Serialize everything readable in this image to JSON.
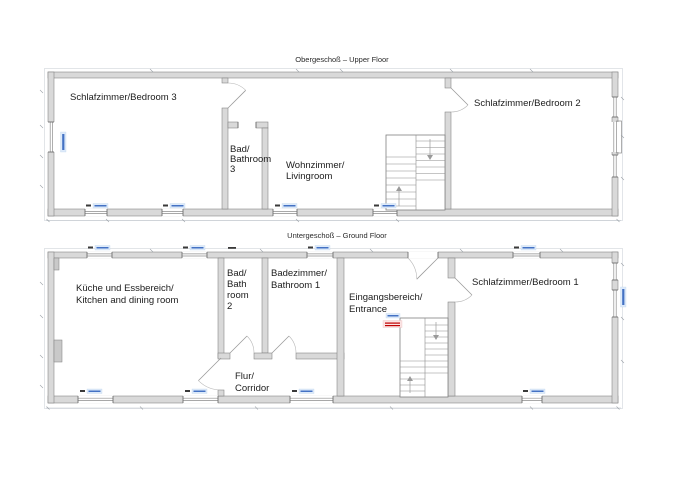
{
  "document": {
    "type": "architectural floor plan, two storeys",
    "background_color": "#ffffff",
    "line_color": "#7f7f7f",
    "wall_fill_color": "#d9d9d9",
    "annotation_blue": "#4472c4",
    "annotation_red": "#c00000",
    "text_color": "#1c1c1c"
  },
  "titles": {
    "upper": "Obergeschoß – Upper Floor",
    "ground": "Untergeschoß – Ground Floor"
  },
  "floors": {
    "upper": {
      "rooms": {
        "bedroom3": {
          "lines": [
            "Schlafzimmer/Bedroom 3"
          ]
        },
        "bathroom3": {
          "lines": [
            "Bad/",
            "Bathroom",
            "3"
          ]
        },
        "livingroom": {
          "lines": [
            "Wohnzimmer/",
            "Livingroom"
          ]
        },
        "bedroom2": {
          "lines": [
            "Schlafzimmer/Bedroom 2"
          ]
        }
      },
      "features": [
        "staircase with up and down arrows",
        "windows on bottom, left and right walls",
        "door swings to bedroom 2 and from bedroom 3"
      ]
    },
    "ground": {
      "rooms": {
        "kitchen": {
          "lines": [
            "Küche und Essbereich/",
            "Kitchen and dining room"
          ]
        },
        "bathroom2": {
          "lines": [
            "Bad/",
            "Bath",
            "room",
            "2"
          ]
        },
        "bathroom1": {
          "lines": [
            "Badezimmer/",
            "Bathroom 1"
          ]
        },
        "entrance": {
          "lines": [
            "Eingangsbereich/",
            "Entrance"
          ]
        },
        "corridor": {
          "lines": [
            "Flur/",
            "Corridor"
          ]
        },
        "bedroom1": {
          "lines": [
            "Schlafzimmer/Bedroom 1"
          ]
        }
      },
      "features": [
        "staircase with up and down arrows",
        "entrance door in top wall",
        "bathroom doors off corridor",
        "windows on top, bottom and right walls"
      ]
    }
  }
}
